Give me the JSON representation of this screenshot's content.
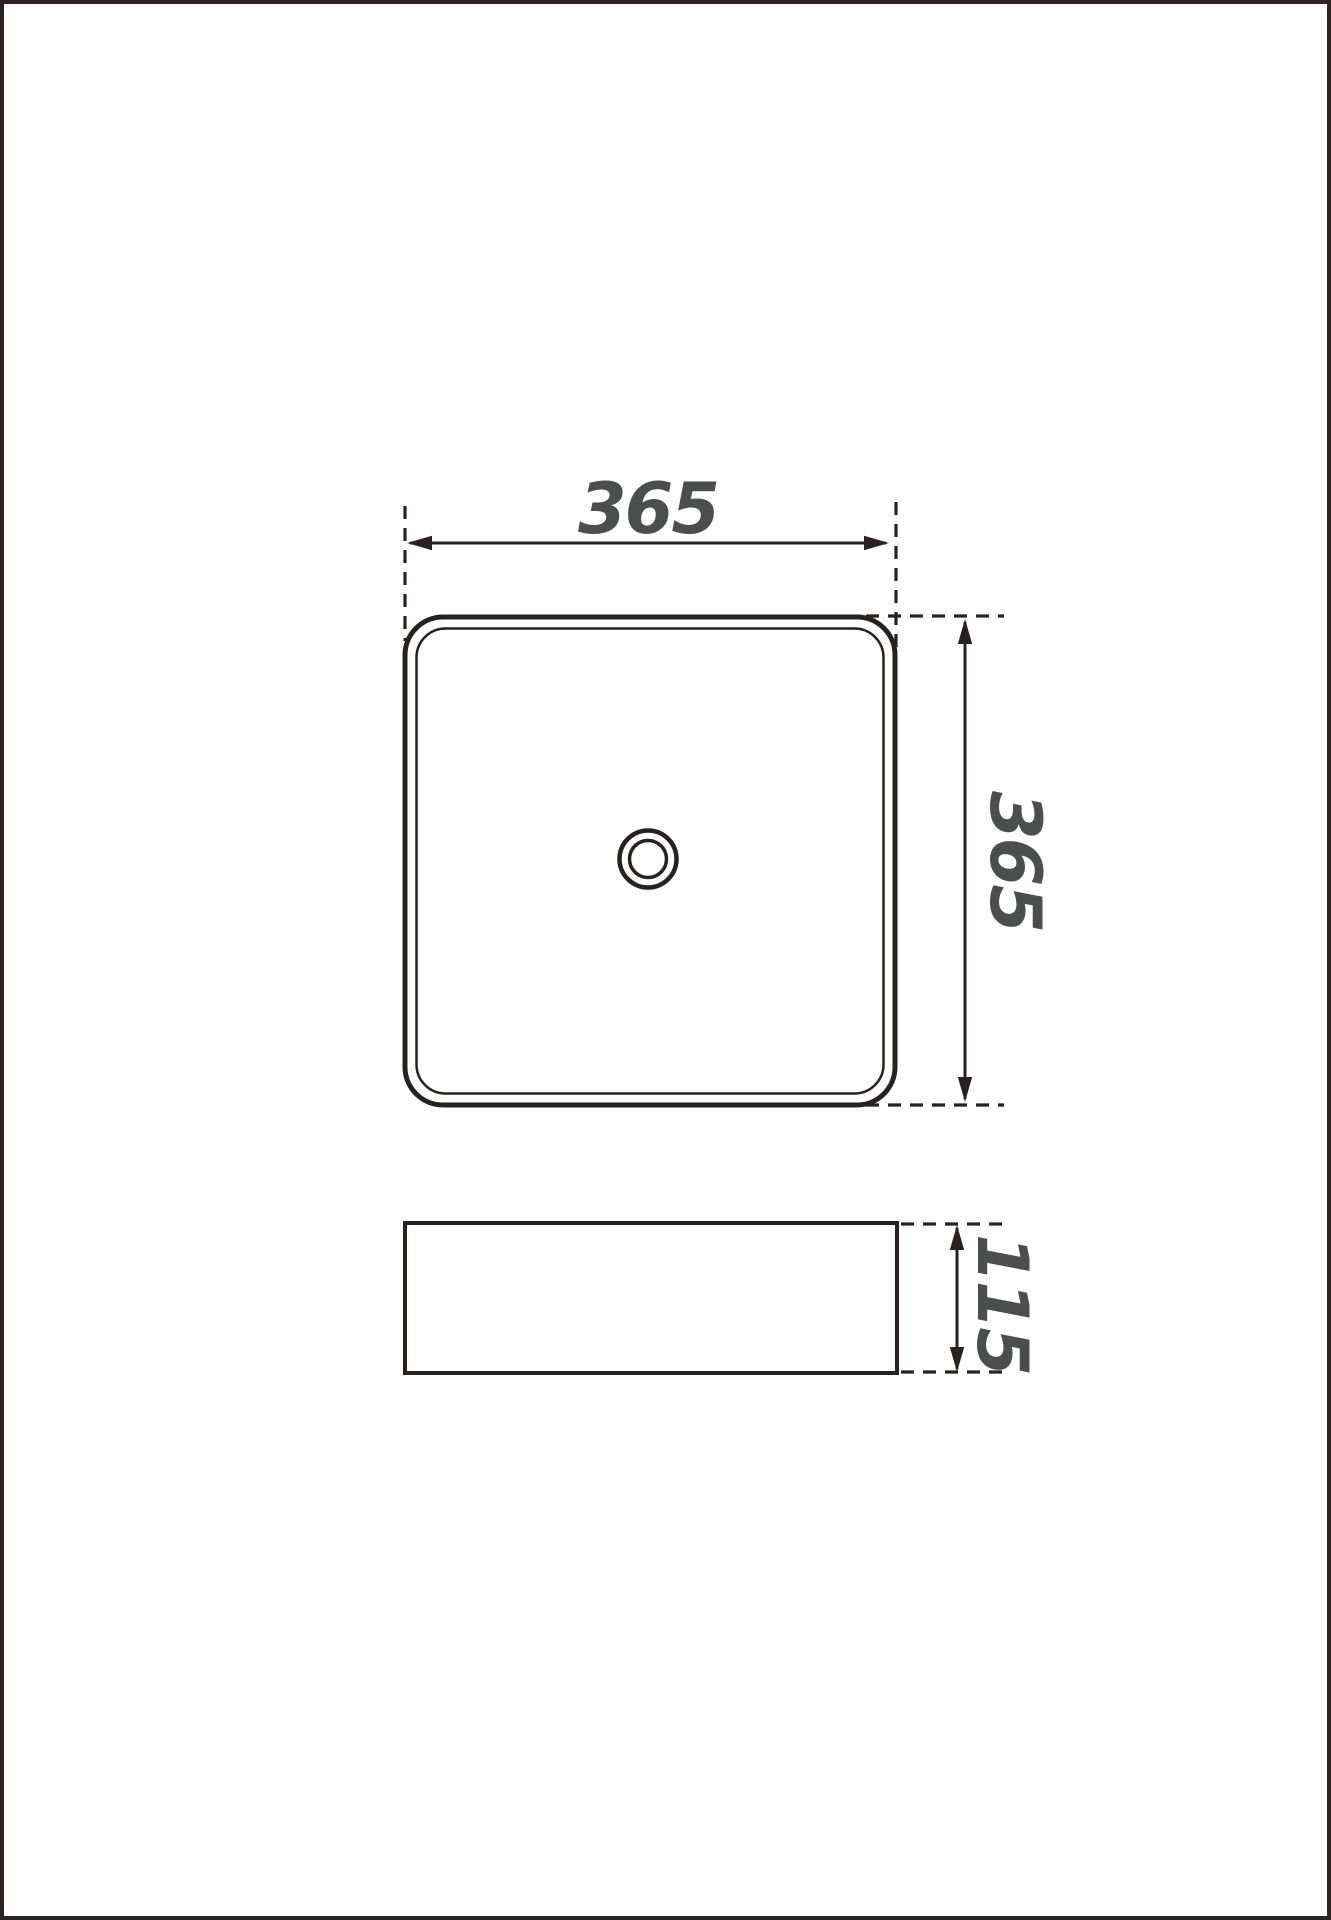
{
  "page": {
    "background": "#ffffff",
    "border_color": "#2b2422"
  },
  "colors": {
    "line": "#272120",
    "dimension_text": "#4c4d4f"
  },
  "diagram": {
    "type": "technical-drawing",
    "dimensions": [
      {
        "id": "plan-width",
        "label": "365"
      },
      {
        "id": "plan-depth",
        "label": "365"
      },
      {
        "id": "elevation-height",
        "label": "115"
      }
    ]
  }
}
